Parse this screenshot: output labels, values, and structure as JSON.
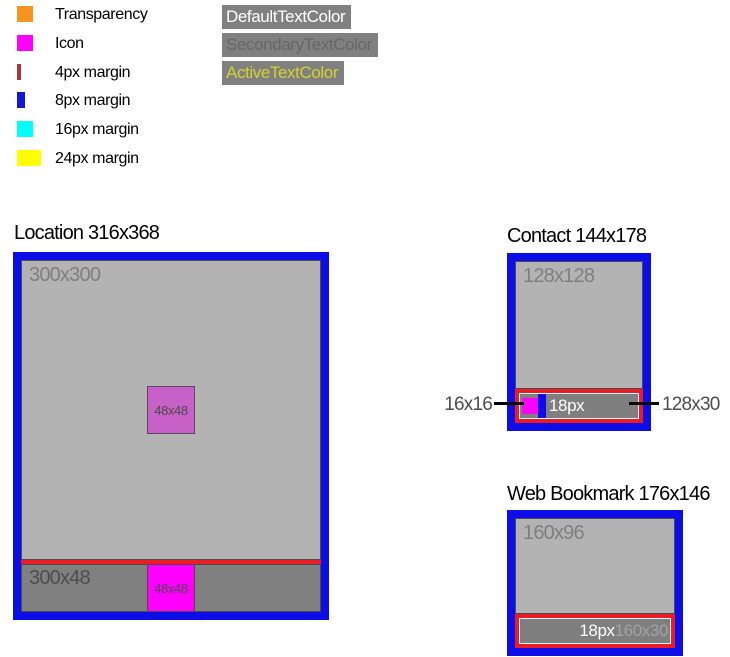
{
  "legend": {
    "items": [
      {
        "label": "Transparency",
        "color": "#f7941e",
        "swatch_style": "background:#f7941e;width:16px;height:16px"
      },
      {
        "label": "Icon",
        "color": "#ff00ff",
        "swatch_style": "background:#ff00ff;width:16px;height:16px"
      },
      {
        "label": "4px margin",
        "color": "#a93439",
        "swatch_style": "background:#a93439;width:4px;height:16px"
      },
      {
        "label": "8px margin",
        "color": "#1414dd",
        "swatch_style": "background:#1414dd;width:8px;height:16px"
      },
      {
        "label": "16px margin",
        "color": "#00ffff",
        "swatch_style": "background:#00ffff;width:16px;height:16px"
      },
      {
        "label": "24px margin",
        "color": "#ffff00",
        "swatch_style": "background:#ffff00;width:24px;height:16px"
      }
    ]
  },
  "text_colors": {
    "box_background": "#808080",
    "items": [
      {
        "label": "DefaultTextColor",
        "color": "#ffffff",
        "style": "color:#ffffff;background:#808080"
      },
      {
        "label": "SecondaryTextColor",
        "color": "#666666",
        "style": "color:#666666;background:#808080"
      },
      {
        "label": "ActiveTextColor",
        "color": "#d3d32b",
        "style": "color:#d3d32b;background:#808080"
      }
    ]
  },
  "location": {
    "title": "Location 316x368",
    "content_label": "300x300",
    "center_icon_label": "48x48",
    "bar_label": "300x48",
    "bar_icon_label": "48x48"
  },
  "contact": {
    "title": "Contact 144x178",
    "content_label": "128x128",
    "text_size_label": "18px",
    "callout_icon_label": "16x16",
    "callout_bar_label": "128x30"
  },
  "web_bookmark": {
    "title": "Web Bookmark 176x146",
    "content_label": "160x96",
    "text_size_label": "18px",
    "bar_size_label": "160x30"
  },
  "colors": {
    "margin_4px_red_stripe": "#ed1c24",
    "margin_8px_blue_border": "#0d0de8",
    "icon_magenta": "#ff00ff",
    "icon_transparent_violet": "#c761c7",
    "surface_light_gray": "#b3b3b3",
    "surface_dark_gray": "#7f7f7f",
    "dim_label_on_light": "#7f7f7f",
    "dim_label_on_dark": "#4d4d4d",
    "page_background": "#ffffff"
  }
}
